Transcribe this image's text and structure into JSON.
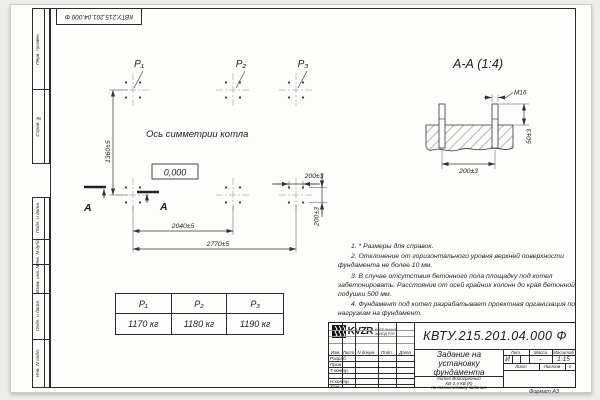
{
  "drawing": {
    "code_stamp": "КВТУ.215.201.04.000 Ф",
    "format": "Формат А3"
  },
  "margin_top": [
    "Перв. примен.",
    "Справ. №"
  ],
  "margin_bottom": [
    "Подп. и дата",
    "Инв. N дубл.",
    "Взам. инв. N",
    "Подп. и дата",
    "Инв. N подл."
  ],
  "plan": {
    "p1": "P₁",
    "p2": "P₂",
    "p3": "P₃",
    "axis_text": "Ось симметрии котла",
    "level": "0,000",
    "dim_height": "1360±5",
    "dim_inner": "2040±5",
    "dim_outer": "2770±5",
    "dim_bolt_h": "200±3",
    "dim_bolt_v": "200±3",
    "cut_label_1": "А",
    "cut_label_2": "А"
  },
  "section": {
    "title": "А-А (1:4)",
    "thread": "М16",
    "dim_height": "50±3",
    "dim_spacing": "200±3"
  },
  "notes": [
    "1. * Размеры для справок.",
    "2. Отклонение от горизонтального уровня верхней поверхности фундамента не более 10 мм.",
    "3. В случае отсутствия бетонного пола площадку под котел забетонировать. Расстояние от осей крайних колонн до края бетонной подушки 500 мм.",
    "4. Фундамент под котел разрабатывает проектная организация по нагрузкам на фундамент."
  ],
  "load_table": {
    "headers": [
      "P₁",
      "P₂",
      "P₃"
    ],
    "values": [
      "1170 кг",
      "1180 кг",
      "1190 кг"
    ]
  },
  "title_block": {
    "designation": "КВТУ.215.201.04.000 Ф",
    "title_l1": "Задание на",
    "title_l2": "установку",
    "title_l3": "фундамента",
    "product_l1": "Котел Водогрейный",
    "product_l2": "КВ-2,5 КБ (К)",
    "product_l3": "по техническому заданию",
    "col_izm": "Изм.",
    "col_list": "Лист",
    "col_ndoc": "N докум.",
    "col_podp": "Подп.",
    "col_data": "Дата",
    "row_razrab": "Разраб.",
    "row_prov": "Пров.",
    "row_tkontr": "Т.контр.",
    "row_nkontr": "Н.контр.",
    "row_utv": "Утв.",
    "lit_h": "Лит.",
    "mass_h": "Масса",
    "scale_h": "Масштаб",
    "lit_v": "И",
    "mass_v": "-",
    "scale_v": "1:15",
    "sheet_h": "Лист",
    "sheets_h": "Листов",
    "sheets_v": "1",
    "logo": "KVZR",
    "logo_sub1": "КОТЕЛЬНЫЙ",
    "logo_sub2": "ЗАВОД РЭТ"
  }
}
